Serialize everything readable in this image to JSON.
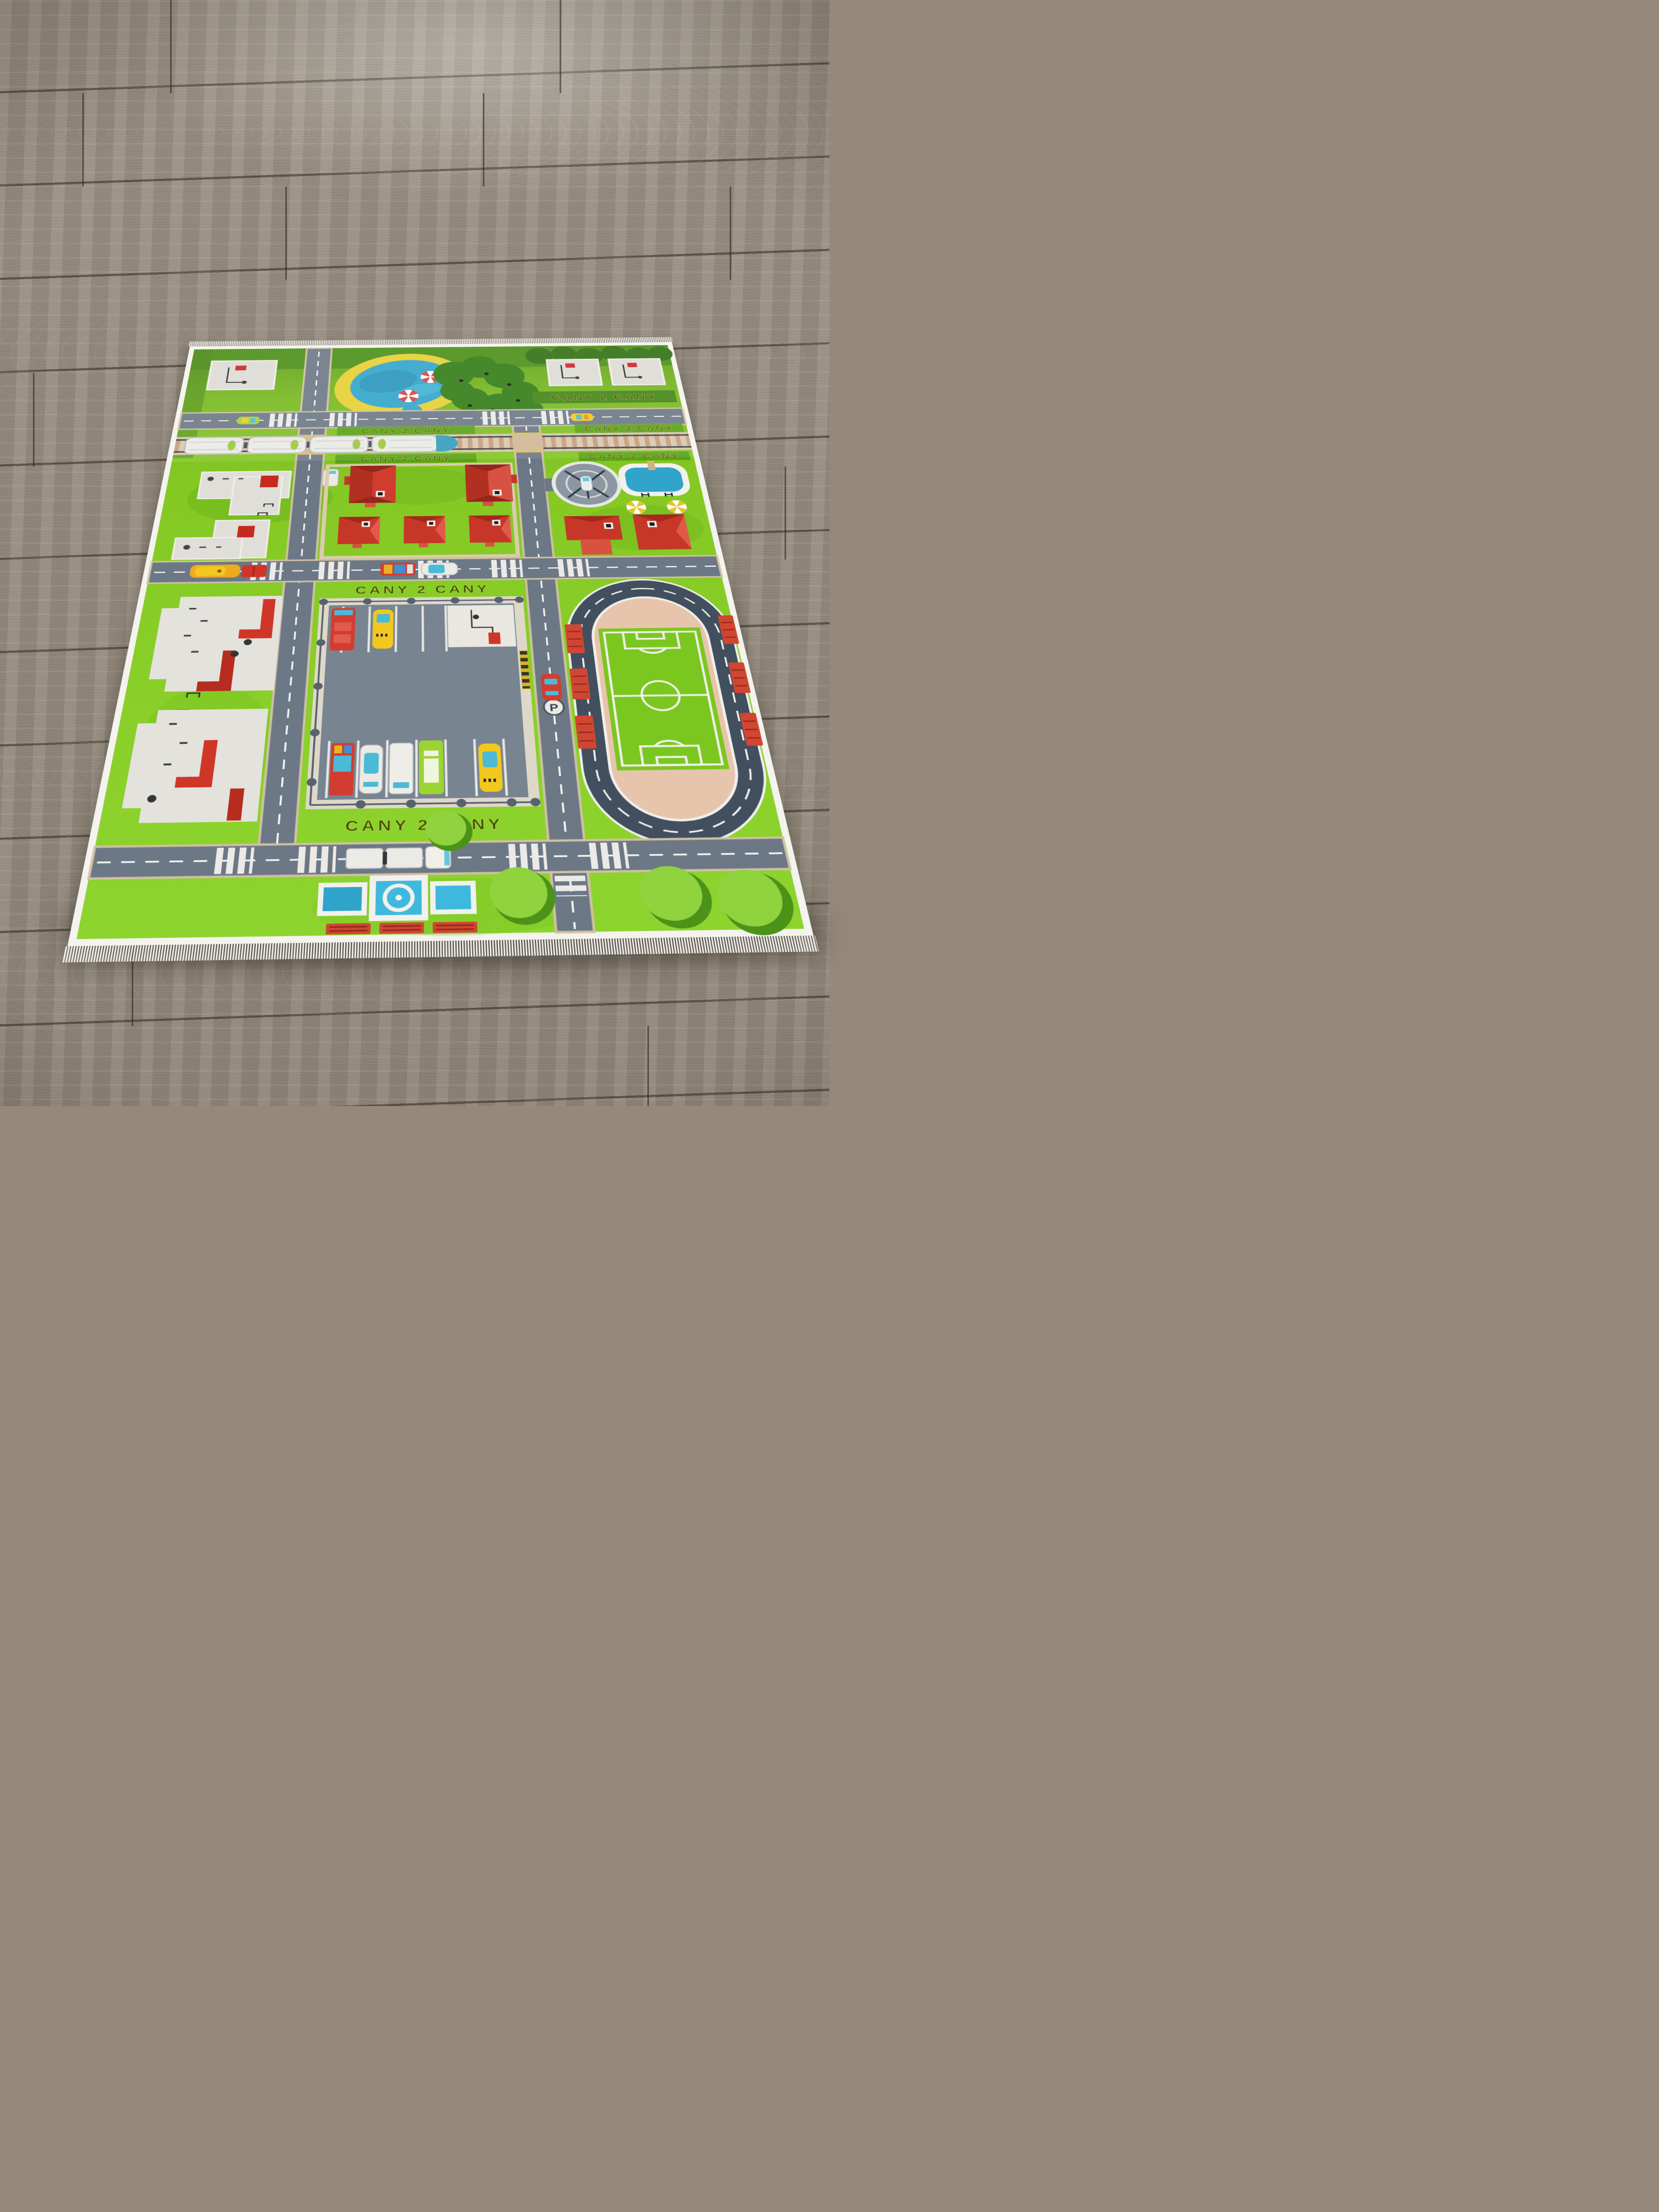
{
  "scene": {
    "description": "Photograph of a children's city-traffic play rug lying on a gray laminate wood floor, viewed at an oblique angle so the rug recedes toward the top of the frame",
    "floor": "gray-taupe wood-grain laminate planks with dark joints and a light glare near the top",
    "rug_edge": "white tassel fringe along the near and far short edges, thin white binding all around"
  },
  "palette": {
    "floor_wood": "#95897b",
    "floor_joint": "#4d463e",
    "fringe": "#f3f2ed",
    "rug_border": "#f4f3ee",
    "grass": "#83c722",
    "grass_dark": "#478c16",
    "hedge_dark": "#2e6e10",
    "road": "#6a7684",
    "road_line": "#f2f2ee",
    "sidewalk": "#d5c6a6",
    "rail_gravel": "#d9c6ad",
    "rail_sleeper": "#c39a78",
    "water": "#2ea3c9",
    "sand": "#e7cd2f",
    "pad_gray": "#dcdbd4",
    "roof_red": "#d03a2c",
    "track": "#404d5d",
    "infield_pink": "#e7c3ab",
    "field_green": "#79c61e",
    "bench_red": "#cf4430",
    "taxi_yellow": "#f2c71d",
    "bus_green": "#9ad32f",
    "glass_teal": "#5fc8dc",
    "train_white": "#e9e9e5",
    "train_nose_blue": "#2f9bbd",
    "flag_red": "#cc2222",
    "umbrella_red": "#d64040"
  },
  "rug": {
    "parking_sign": "P",
    "hedge_lettering": {
      "legible": false,
      "glyphs_approx": "CANY 2 CANY",
      "style": "topiary letters trimmed into the lawn, dark olive letterforms with yellow-green outline; repeated in six hedge strips"
    },
    "features": {
      "park": [
        "blue pond with yellow sand shore",
        "small round pond",
        "two red-white parasols",
        "dense dark tree grove",
        "three gray playground pads with red flags and black paths"
      ],
      "railway": [
        "white passenger train with blue rounded nose",
        "tan sleeper track",
        "two level crossings with yellow posts"
      ],
      "housing_blocks": [
        "two large red-roofed houses",
        "three small red-roofed houses",
        "two gray Z-shaped building pads",
        "helipad circle with helicopter",
        "swimming pool with ladder and diving board",
        "two yellow-white parasols",
        "red L-shaped house",
        "red square house"
      ],
      "center": [
        "fenced parking lot with white stalls",
        "kiosk pad",
        "barrier gate with yellow-black stripes",
        "P sign",
        "parked vehicles: fire truck, taxi, police car, white van, green bus"
      ],
      "left_blocks": [
        "two white apartment building footprints with red entrance roofs",
        "mini football goals",
        "red parked car"
      ],
      "stadium": [
        "oval racing track with dashed white centre line",
        "pink athletics infield",
        "green soccer pitch with white markings",
        "six red benches"
      ],
      "bottom": [
        "cross-shaped fountain with white ring",
        "three red benches",
        "round trees with shadow crescents",
        "white semi-truck",
        "red car",
        "orange bus with red trailer",
        "zebra crosswalks",
        "dashed road markings"
      ]
    }
  }
}
